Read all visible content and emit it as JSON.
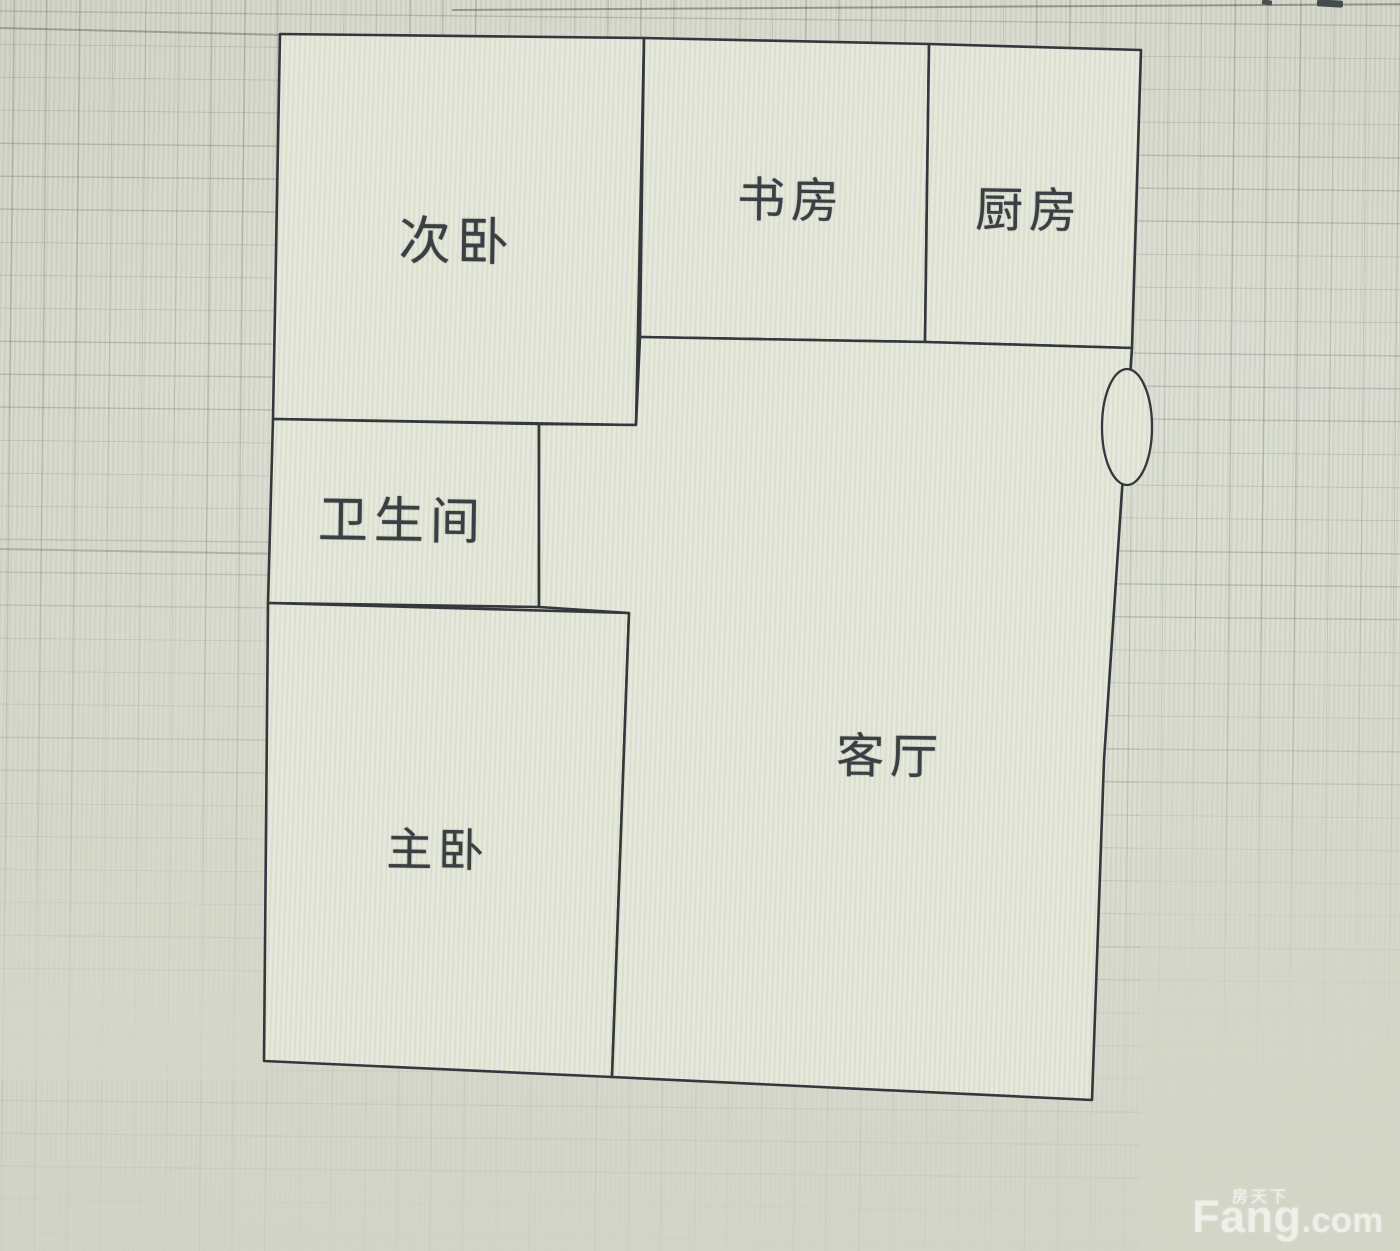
{
  "floor_plan": {
    "rooms": [
      {
        "name": "secondary-bedroom",
        "label": "次卧"
      },
      {
        "name": "study",
        "label": "书房"
      },
      {
        "name": "kitchen",
        "label": "厨房"
      },
      {
        "name": "bathroom",
        "label": "卫生间"
      },
      {
        "name": "master-bedroom",
        "label": "主卧"
      },
      {
        "name": "living-room",
        "label": "客厅"
      }
    ],
    "colors": {
      "wall": "#33383b",
      "room_fill": "#e6e8db",
      "background": "#d6d8ca",
      "label_text": "#3a3f43",
      "watermark": "#ffffff"
    }
  },
  "watermark": {
    "brand_cn": "房天下",
    "brand_en_main": "Fang",
    "brand_en_suffix": ".com"
  }
}
